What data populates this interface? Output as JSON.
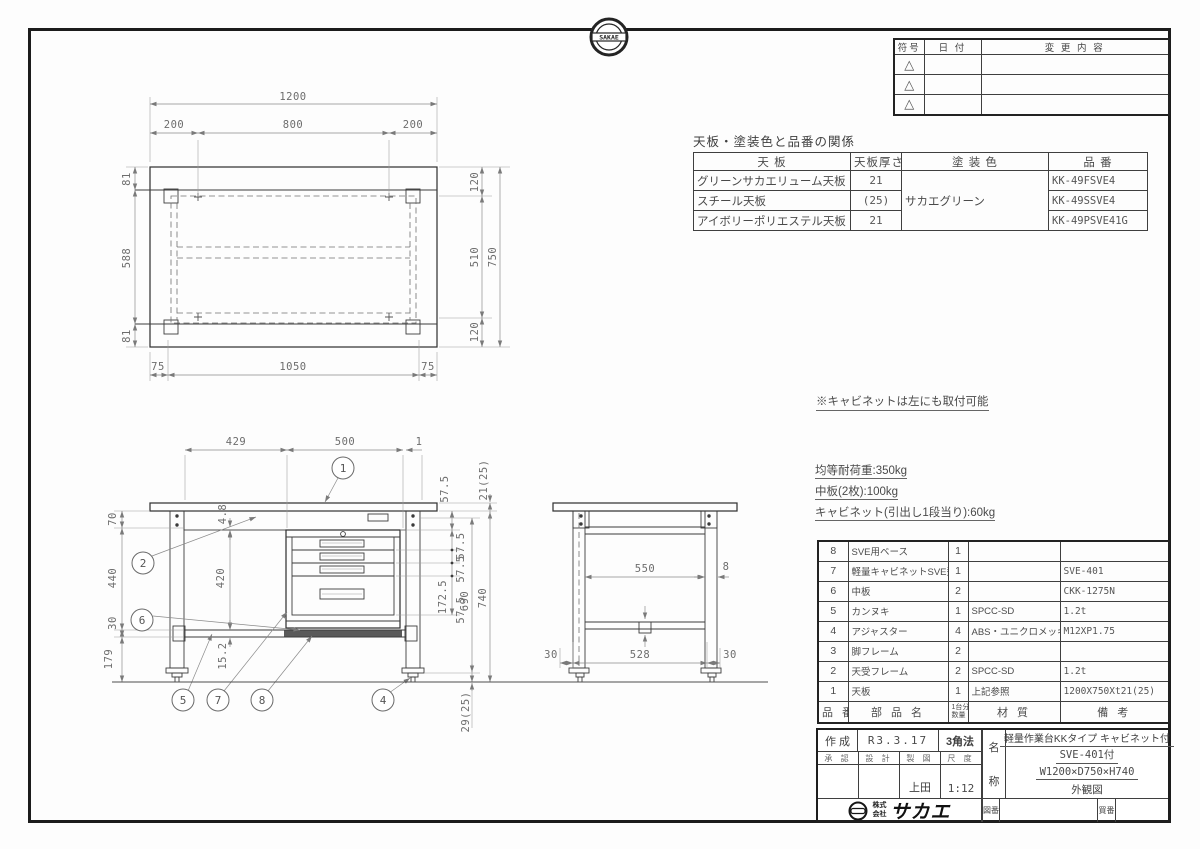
{
  "sheet": {
    "badge_text": "SAKAE"
  },
  "revision": {
    "headers": [
      "符号",
      "日  付",
      "変  更  内  容"
    ],
    "symbol": "△"
  },
  "finish": {
    "title": "天板・塗装色と品番の関係",
    "h_plate": "天  板",
    "h_thick": "天板厚さ",
    "h_color": "塗  装  色",
    "h_part": "品  番",
    "paint_color": "サカエグリーン",
    "rows": [
      [
        "グリーンサカエリューム天板",
        "21",
        "KK-49FSVE4"
      ],
      [
        "スチール天板",
        "(25)",
        "KK-49SSVE4"
      ],
      [
        "アイボリーポリエステル天板",
        "21",
        "KK-49PSVE41G"
      ]
    ]
  },
  "notes": {
    "cabinet": "※キャビネットは左にも取付可能",
    "loads": [
      "均等耐荷重:350kg",
      "中板(2枚):100kg",
      "キャビネット(引出し1段当り):60kg"
    ]
  },
  "parts": {
    "h_num": "品 番",
    "h_name": "部  品  名",
    "qty_top": "1台分",
    "qty_bottom": "数量",
    "h_mat": "材  質",
    "h_rem": "備  考",
    "rows": [
      [
        "8",
        "SVE用ベース",
        "1",
        "",
        ""
      ],
      [
        "7",
        "軽量キャビネットSVE型",
        "1",
        "",
        "SVE-401"
      ],
      [
        "6",
        "中板",
        "2",
        "",
        "CKK-1275N"
      ],
      [
        "5",
        "カンヌキ",
        "1",
        "SPCC-SD",
        "1.2t"
      ],
      [
        "4",
        "アジャスター",
        "4",
        "ABS・ユニクロメッキ",
        "M12XP1.75"
      ],
      [
        "3",
        "脚フレーム",
        "2",
        "",
        ""
      ],
      [
        "2",
        "天受フレーム",
        "2",
        "SPCC-SD",
        "1.2t"
      ],
      [
        "1",
        "天板",
        "1",
        "上記参照",
        "1200X750Xt21(25)"
      ]
    ]
  },
  "title_block": {
    "created_label": "作 成",
    "created_date": "R3.3.17",
    "projection": "3角法",
    "h_approve": "承 認",
    "h_design": "設 計",
    "h_draft": "製 図",
    "h_scale": "尺 度",
    "drafter": "上田",
    "scale": "1:12",
    "name_label_top": "名",
    "name_label_bottom": "称",
    "name1": "軽量作業台KKタイプ キャビネット付",
    "name2": "SVE-401付",
    "name3": "W1200×D750×H740",
    "name4": "外観図",
    "co_prefix_top": "株式",
    "co_prefix_bottom": "会社",
    "co_name": "サカエ",
    "drawing_no_label": "図番",
    "buy_no_label": "買番"
  },
  "dims": {
    "plan": {
      "w": "1200",
      "a": "200",
      "b": "800",
      "c": "200",
      "l1": "81",
      "l2": "588",
      "l3": "81",
      "r1": "120",
      "r2": "510",
      "r3": "120",
      "r4": "750",
      "b1": "75",
      "b2": "1050",
      "b3": "75"
    },
    "front": {
      "t1": "429",
      "t2": "500",
      "t3": "1",
      "l1": "70",
      "l2": "440",
      "l3": "30",
      "l4": "179",
      "m1": "4.8",
      "m2": "420",
      "m3": "15.2",
      "r1": "21(25)",
      "r2": "57.5",
      "r3": "57.5",
      "r4": "57.5",
      "r5": "172.5",
      "r6": "57.5",
      "r7": "690",
      "r8": "740",
      "r9": "29(25)"
    },
    "side": {
      "d1": "550",
      "d2": "8",
      "d3": "30",
      "d4": "528",
      "d5": "30"
    },
    "balloons": {
      "n1": "1",
      "n2": "2",
      "n4": "4",
      "n5": "5",
      "n6": "6",
      "n7": "7",
      "n8": "8"
    }
  }
}
